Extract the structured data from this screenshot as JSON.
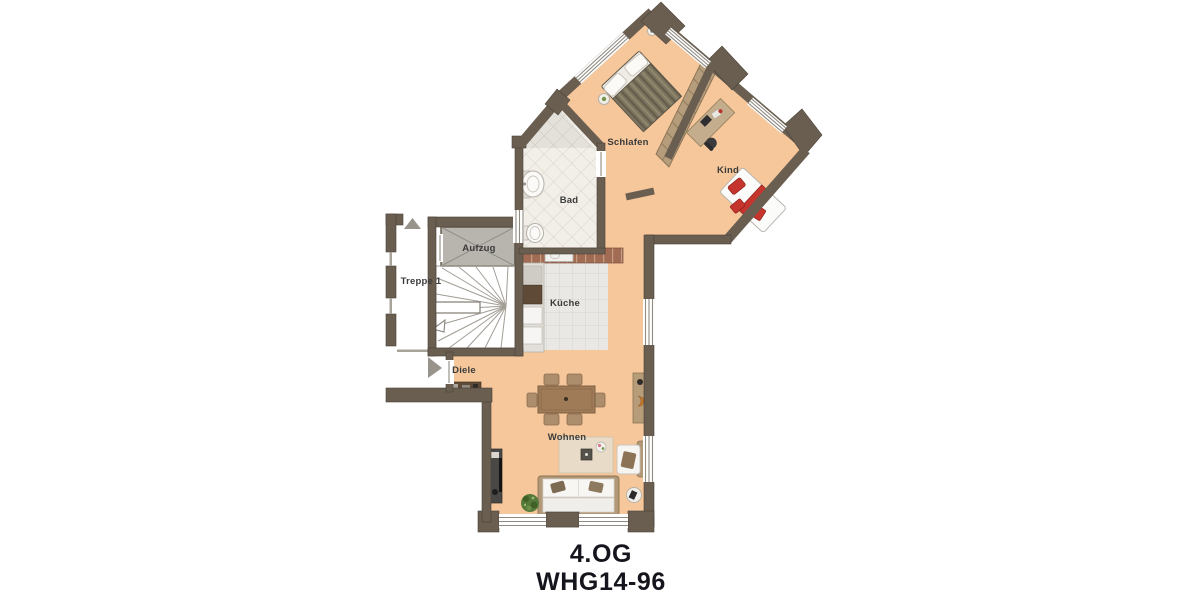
{
  "floor_plan": {
    "caption": {
      "floor": "4.OG",
      "unit": "WHG14-96"
    },
    "rooms": [
      {
        "key": "schlafen",
        "label": "Schlafen"
      },
      {
        "key": "kind",
        "label": "Kind"
      },
      {
        "key": "bad",
        "label": "Bad"
      },
      {
        "key": "kueche",
        "label": "Küche"
      },
      {
        "key": "diele",
        "label": "Diele"
      },
      {
        "key": "wohnen",
        "label": "Wohnen"
      },
      {
        "key": "aufzug",
        "label": "Aufzug"
      },
      {
        "key": "treppe",
        "label": "Treppe 1"
      }
    ],
    "icons": [
      {
        "name": "entrance-arrow-icon",
        "meaning": "apartment entrance direction"
      },
      {
        "name": "up-arrow-icon",
        "meaning": "facade orientation marker"
      }
    ],
    "colors": {
      "wall": "#6a5e51",
      "floor": "#f6c79a",
      "bath_tile": "#f2efe9",
      "kitchen_tile": "#e9e8e5",
      "elevator": "#b8b5af",
      "accent_red": "#c5372d",
      "wood": "#a07b58",
      "caption_text": "#15151d",
      "label_text": "#3b3b3b"
    }
  }
}
